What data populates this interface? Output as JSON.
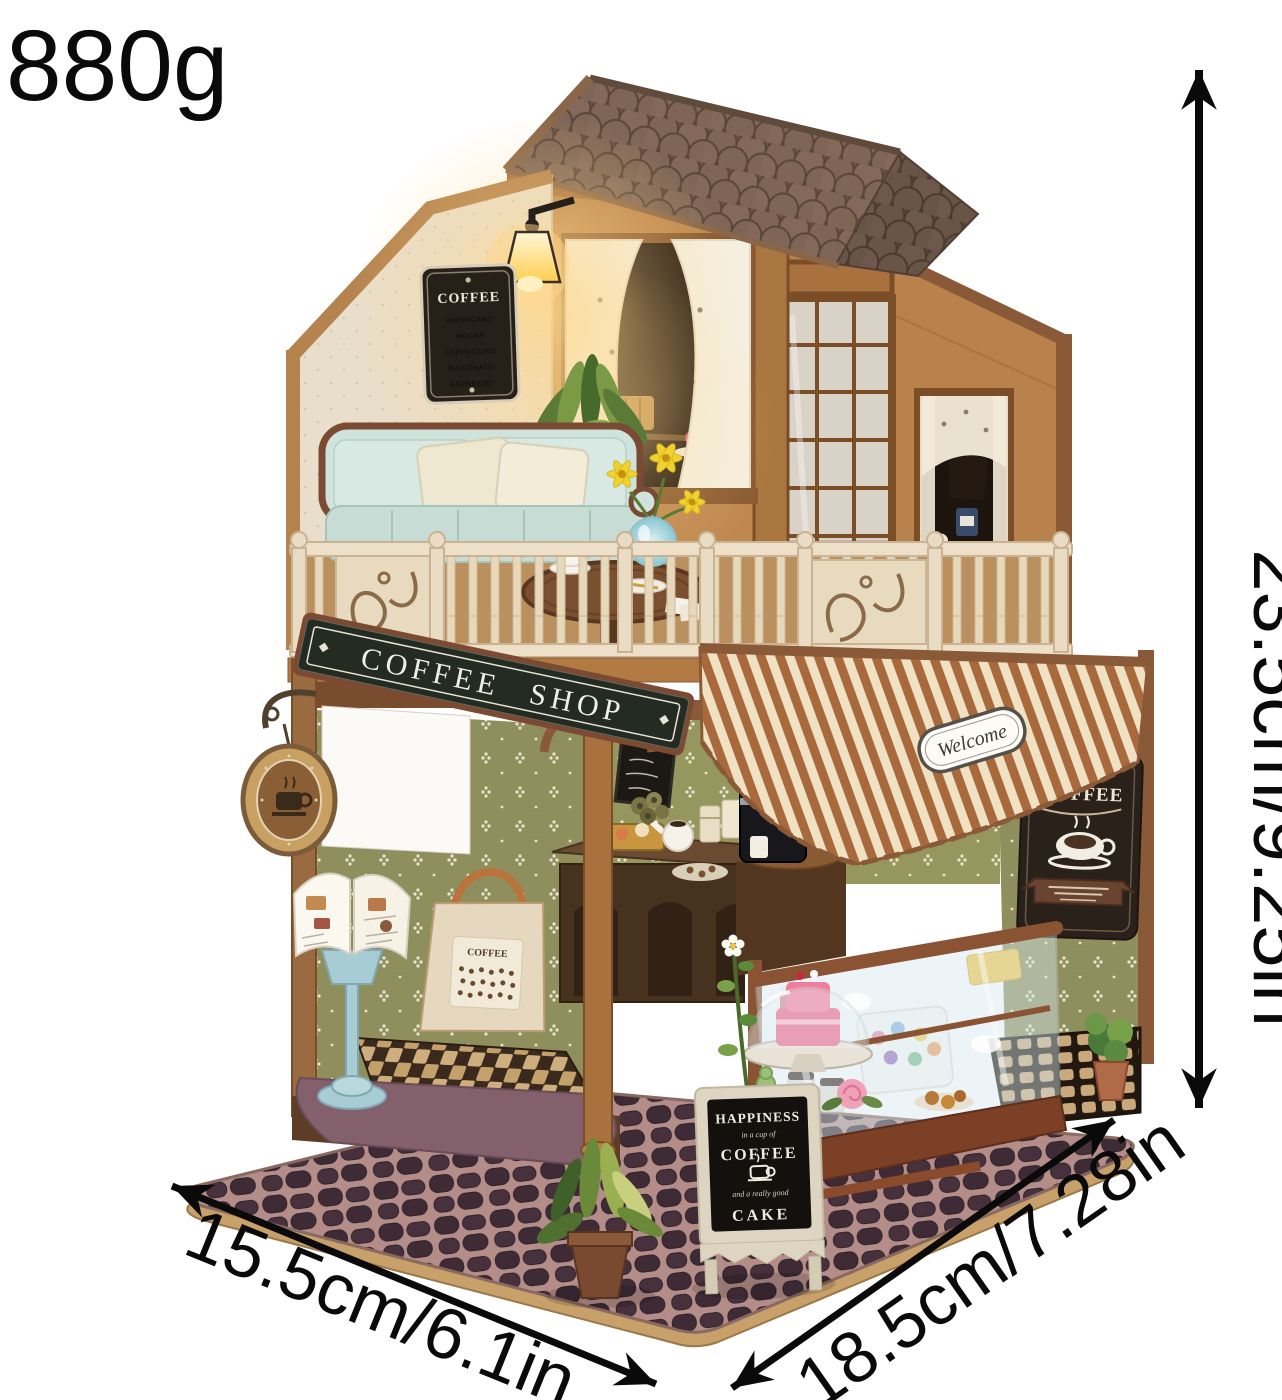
{
  "product": {
    "weight_label": "880g",
    "height_label": "23.5cm/9.25in",
    "base_left_label": "15.5cm/6.1in",
    "base_right_label": "18.5cm/7.28in"
  },
  "signs": {
    "shop_sign": "COFFEE SHOP",
    "menu_board": {
      "title": "COFFEE",
      "items": [
        "AMERICANO",
        "MOCHA",
        "CAPPUCCINO",
        "MACCHIATO",
        "ESPRESSO"
      ]
    },
    "welcome_sticker": "Welcome",
    "wall_sign": {
      "title": "COFFEE"
    },
    "aframe_sign": {
      "headline": "HAPPINESS",
      "script_top": "in a cup of",
      "middle": "COFFEE",
      "script_bottom": "and a really good",
      "bottom": "CAKE"
    },
    "tote_bag": {
      "label": "COFFEE"
    }
  },
  "icons": {
    "hanging_sign_icon": "coffee-cup-badge",
    "wall_sign_icon": "coffee-cup",
    "aframe_sign_icon": "coffee-cup",
    "dimension_arrows": "double-headed-arrow"
  },
  "colors": {
    "background": "#ffffff",
    "annotation": "#0a0a0a",
    "roof_shingle": "#7b6253",
    "wood_light": "#b98a4e",
    "wood_frame": "#8a5a38",
    "gable_cream": "#e9decb",
    "sofa_blue": "#cfe2dc",
    "railing_cream": "#eadcc4",
    "sign_board": "#232b22",
    "awning_brown": "#a8693c",
    "awning_cream": "#f0e1c3",
    "wall_olive": "#8f8f5e",
    "base_stone": "#3e2b36",
    "glow_warm": "#ffd88c"
  }
}
